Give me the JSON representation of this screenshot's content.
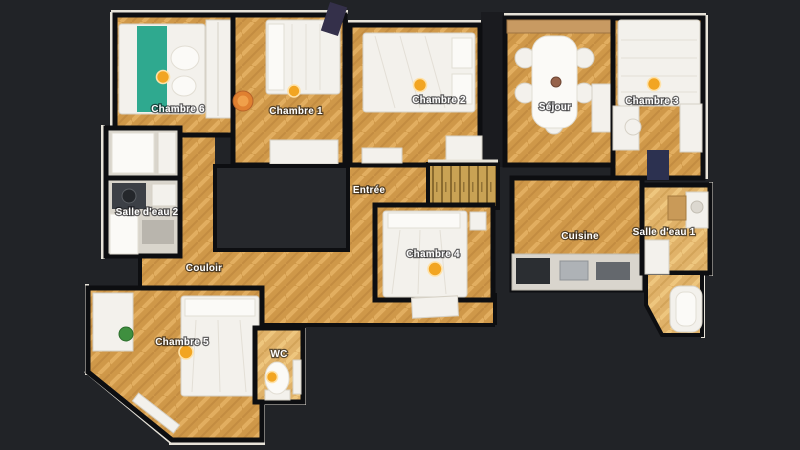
{
  "floorplan": {
    "rooms": [
      {
        "id": "chambre-6",
        "label": "Chambre 6"
      },
      {
        "id": "chambre-1",
        "label": "Chambre 1"
      },
      {
        "id": "chambre-2",
        "label": "Chambre 2"
      },
      {
        "id": "sejour",
        "label": "Séjour"
      },
      {
        "id": "chambre-3",
        "label": "Chambre 3"
      },
      {
        "id": "salle-deau-2",
        "label": "Salle d'eau 2"
      },
      {
        "id": "entree",
        "label": "Entrée"
      },
      {
        "id": "chambre-4",
        "label": "Chambre 4"
      },
      {
        "id": "cuisine",
        "label": "Cuisine"
      },
      {
        "id": "salle-deau-1",
        "label": "Salle d'eau 1"
      },
      {
        "id": "couloir",
        "label": "Couloir"
      },
      {
        "id": "chambre-5",
        "label": "Chambre 5"
      },
      {
        "id": "wc",
        "label": "WC"
      }
    ],
    "pano_markers": [
      {
        "room_id": "chambre-6"
      },
      {
        "room_id": "chambre-1"
      },
      {
        "room_id": "chambre-2"
      },
      {
        "room_id": "chambre-3"
      },
      {
        "room_id": "chambre-4"
      },
      {
        "room_id": "chambre-5"
      },
      {
        "room_id": "wc"
      }
    ],
    "colors": {
      "background": "#212327",
      "floor_wood": "#cf9849",
      "floor_wood_light": "#e0b269",
      "bathroom_floor": "#d9d5cc",
      "wall": "#0d0e11",
      "wall_top_white": "#e7e3d9",
      "furniture_white": "#f3f1ec",
      "bed_blanket_teal": "#2fa98f",
      "pano_marker": "#f2a522"
    }
  }
}
